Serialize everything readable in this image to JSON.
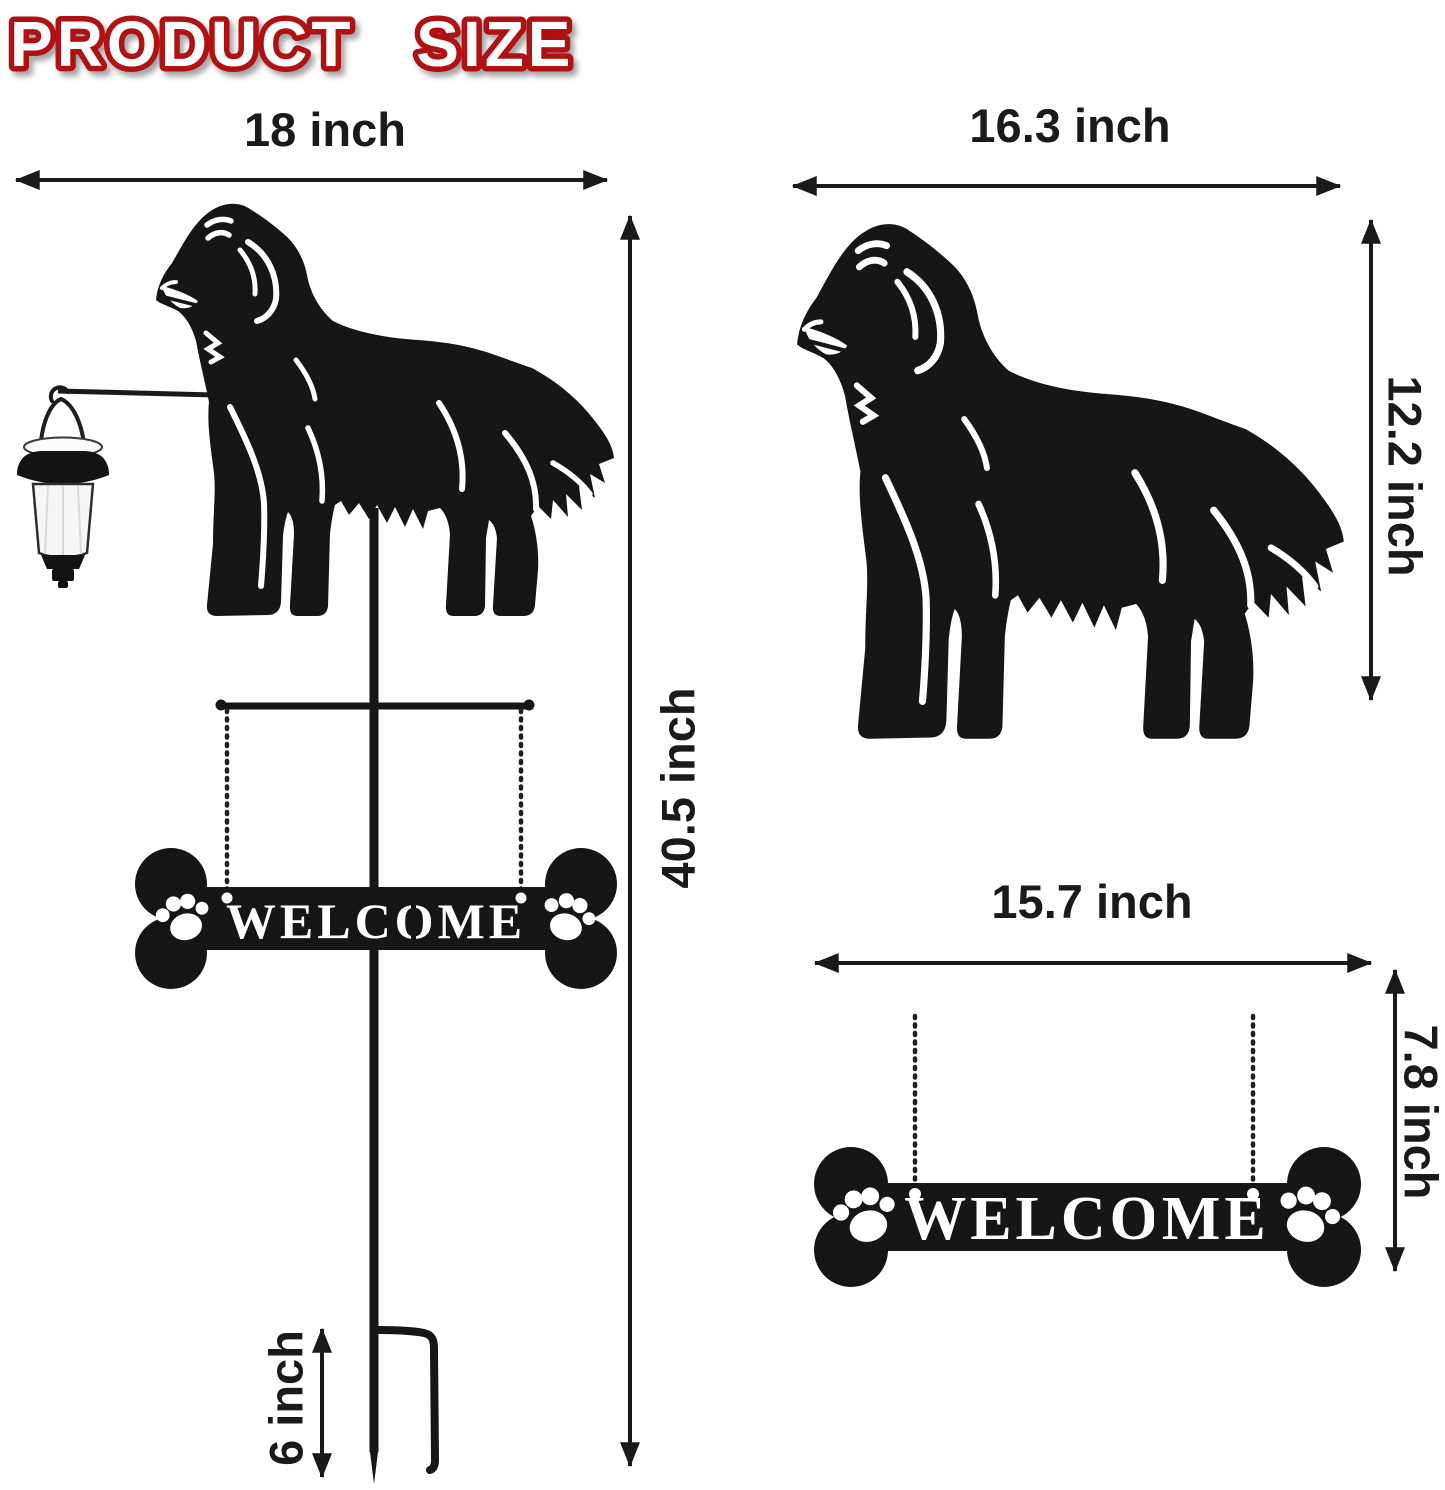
{
  "title": {
    "text": "PRODUCT SIZE"
  },
  "sign": {
    "text": "WELCOME"
  },
  "dims": {
    "total_width": "18 inch",
    "total_height": "40.5 inch",
    "stake_depth": "6 inch",
    "dog_width": "16.3 inch",
    "dog_height": "12.2 inch",
    "sign_width": "15.7 inch",
    "sign_height": "7.8 inch"
  },
  "colors": {
    "title_red": "#b01113",
    "silhouette_black": "#161616",
    "label_black": "#1a1a1a",
    "background": "#ffffff"
  },
  "icons": {
    "dog-silhouette-icon": "golden retriever side silhouette",
    "paw-print-icon": "dog paw print",
    "bone-sign-icon": "dog bone welcome plaque",
    "lantern-icon": "hanging solar lantern",
    "dimension-arrow-icon": "double-headed measurement arrow"
  }
}
